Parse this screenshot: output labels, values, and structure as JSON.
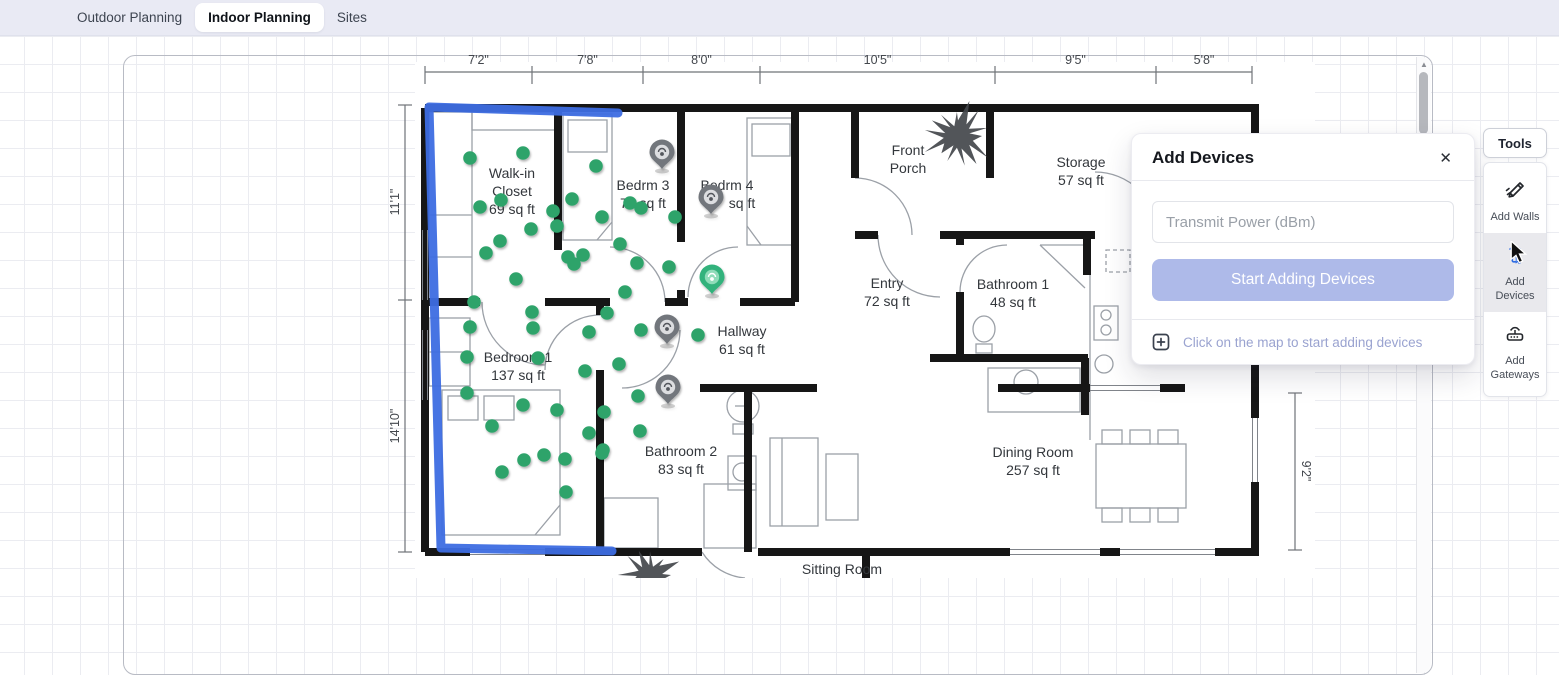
{
  "topbar": {
    "tabs": [
      {
        "label": "Outdoor Planning",
        "active": false
      },
      {
        "label": "Indoor Planning",
        "active": true
      },
      {
        "label": "Sites",
        "active": false
      }
    ]
  },
  "dialog": {
    "title": "Add Devices",
    "close_label": "✕",
    "input_placeholder": "Transmit Power (dBm)",
    "submit_label": "Start Adding Devices",
    "hint": "Click on the map to start adding devices"
  },
  "tools": {
    "title": "Tools",
    "items": [
      {
        "id": "add-walls",
        "label": "Add Walls",
        "active": false
      },
      {
        "id": "add-devices",
        "label": "Add Devices",
        "active": true
      },
      {
        "id": "add-gateways",
        "label": "Add Gateways",
        "active": false
      }
    ]
  },
  "floorplan": {
    "rooms": [
      {
        "name": "walk-in-closet",
        "lines": [
          "Walk-in",
          "Closet",
          "69 sq ft"
        ],
        "x": 512,
        "y": 178,
        "lh": 18
      },
      {
        "name": "bedrm-3",
        "lines": [
          "Bedrm 3",
          "73 sq ft"
        ],
        "x": 643,
        "y": 190,
        "lh": 18
      },
      {
        "name": "bedrm-4",
        "lines": [
          "Bedrm 4"
        ],
        "x": 727,
        "y": 190,
        "lh": 18
      },
      {
        "name": "bedrm-4-area",
        "lines": [
          "sq ft"
        ],
        "x": 742,
        "y": 208,
        "lh": 18
      },
      {
        "name": "front-porch",
        "lines": [
          "Front",
          "Porch"
        ],
        "x": 908,
        "y": 155,
        "lh": 18
      },
      {
        "name": "storage",
        "lines": [
          "Storage",
          "57 sq ft"
        ],
        "x": 1081,
        "y": 167,
        "lh": 18
      },
      {
        "name": "entry",
        "lines": [
          "Entry",
          "72 sq ft"
        ],
        "x": 887,
        "y": 288,
        "lh": 18
      },
      {
        "name": "bathroom-1",
        "lines": [
          "Bathroom 1",
          "48 sq ft"
        ],
        "x": 1013,
        "y": 289,
        "lh": 18
      },
      {
        "name": "hallway",
        "lines": [
          "Hallway",
          "61 sq ft"
        ],
        "x": 742,
        "y": 336,
        "lh": 18
      },
      {
        "name": "bedroom-1",
        "lines": [
          "Bedroom 1",
          "137 sq ft"
        ],
        "x": 518,
        "y": 362,
        "lh": 18
      },
      {
        "name": "bathroom-2",
        "lines": [
          "Bathroom 2",
          "83 sq ft"
        ],
        "x": 681,
        "y": 456,
        "lh": 18
      },
      {
        "name": "dining-room",
        "lines": [
          "Dining Room",
          "257 sq ft"
        ],
        "x": 1033,
        "y": 457,
        "lh": 18
      },
      {
        "name": "sitting-room",
        "lines": [
          "Sitting Room"
        ],
        "x": 842,
        "y": 574,
        "lh": 18
      }
    ],
    "dimensions": {
      "top": {
        "y": 72,
        "label_y": 64,
        "ticks": [
          425,
          532,
          643,
          760,
          995,
          1156,
          1252
        ],
        "labels": [
          "7'2\"",
          "7'8\"",
          "8'0\"",
          "10'5\"",
          "9'5\"",
          "5'8\""
        ]
      },
      "left": {
        "x": 405,
        "ticks": [
          105,
          300,
          552
        ],
        "labels": [
          {
            "text": "11'1\"",
            "y": 202
          },
          {
            "text": "14'10\"",
            "y": 426
          }
        ]
      },
      "right": {
        "x": 1295,
        "ticks": [
          393,
          550
        ],
        "labels": [
          {
            "text": "9'2\"",
            "y": 471
          }
        ]
      }
    },
    "devices": [
      [
        470,
        158
      ],
      [
        523,
        153
      ],
      [
        596,
        166
      ],
      [
        501,
        200
      ],
      [
        480,
        207
      ],
      [
        553,
        211
      ],
      [
        572,
        199
      ],
      [
        602,
        217
      ],
      [
        630,
        203
      ],
      [
        641,
        208
      ],
      [
        675,
        217
      ],
      [
        557,
        226
      ],
      [
        531,
        229
      ],
      [
        500,
        241
      ],
      [
        486,
        253
      ],
      [
        620,
        244
      ],
      [
        568,
        257
      ],
      [
        583,
        255
      ],
      [
        574,
        264
      ],
      [
        637,
        263
      ],
      [
        669,
        267
      ],
      [
        516,
        279
      ],
      [
        625,
        292
      ],
      [
        474,
        302
      ],
      [
        532,
        312
      ],
      [
        607,
        313
      ],
      [
        470,
        327
      ],
      [
        533,
        328
      ],
      [
        589,
        332
      ],
      [
        641,
        330
      ],
      [
        698,
        335
      ],
      [
        467,
        357
      ],
      [
        538,
        358
      ],
      [
        619,
        364
      ],
      [
        585,
        371
      ],
      [
        467,
        393
      ],
      [
        638,
        396
      ],
      [
        523,
        405
      ],
      [
        557,
        410
      ],
      [
        604,
        412
      ],
      [
        492,
        426
      ],
      [
        640,
        431
      ],
      [
        589,
        433
      ],
      [
        603,
        450
      ],
      [
        544,
        455
      ],
      [
        524,
        460
      ],
      [
        565,
        459
      ],
      [
        502,
        472
      ],
      [
        602,
        453
      ],
      [
        566,
        492
      ]
    ],
    "markers": [
      {
        "x": 662,
        "y": 153,
        "type": "gray"
      },
      {
        "x": 711,
        "y": 198,
        "type": "gray"
      },
      {
        "x": 667,
        "y": 328,
        "type": "gray"
      },
      {
        "x": 668,
        "y": 388,
        "type": "gray"
      },
      {
        "x": 712,
        "y": 278,
        "type": "green"
      }
    ],
    "colors": {
      "device": "#2fa36b",
      "marker_gray": "#72767c",
      "marker_green": "#33b27c",
      "wall": "#161616",
      "drawn_wall": "#3d6de2",
      "furniture": "#9ba0a7",
      "label": "#33373c",
      "dimension": "#43474d"
    }
  }
}
